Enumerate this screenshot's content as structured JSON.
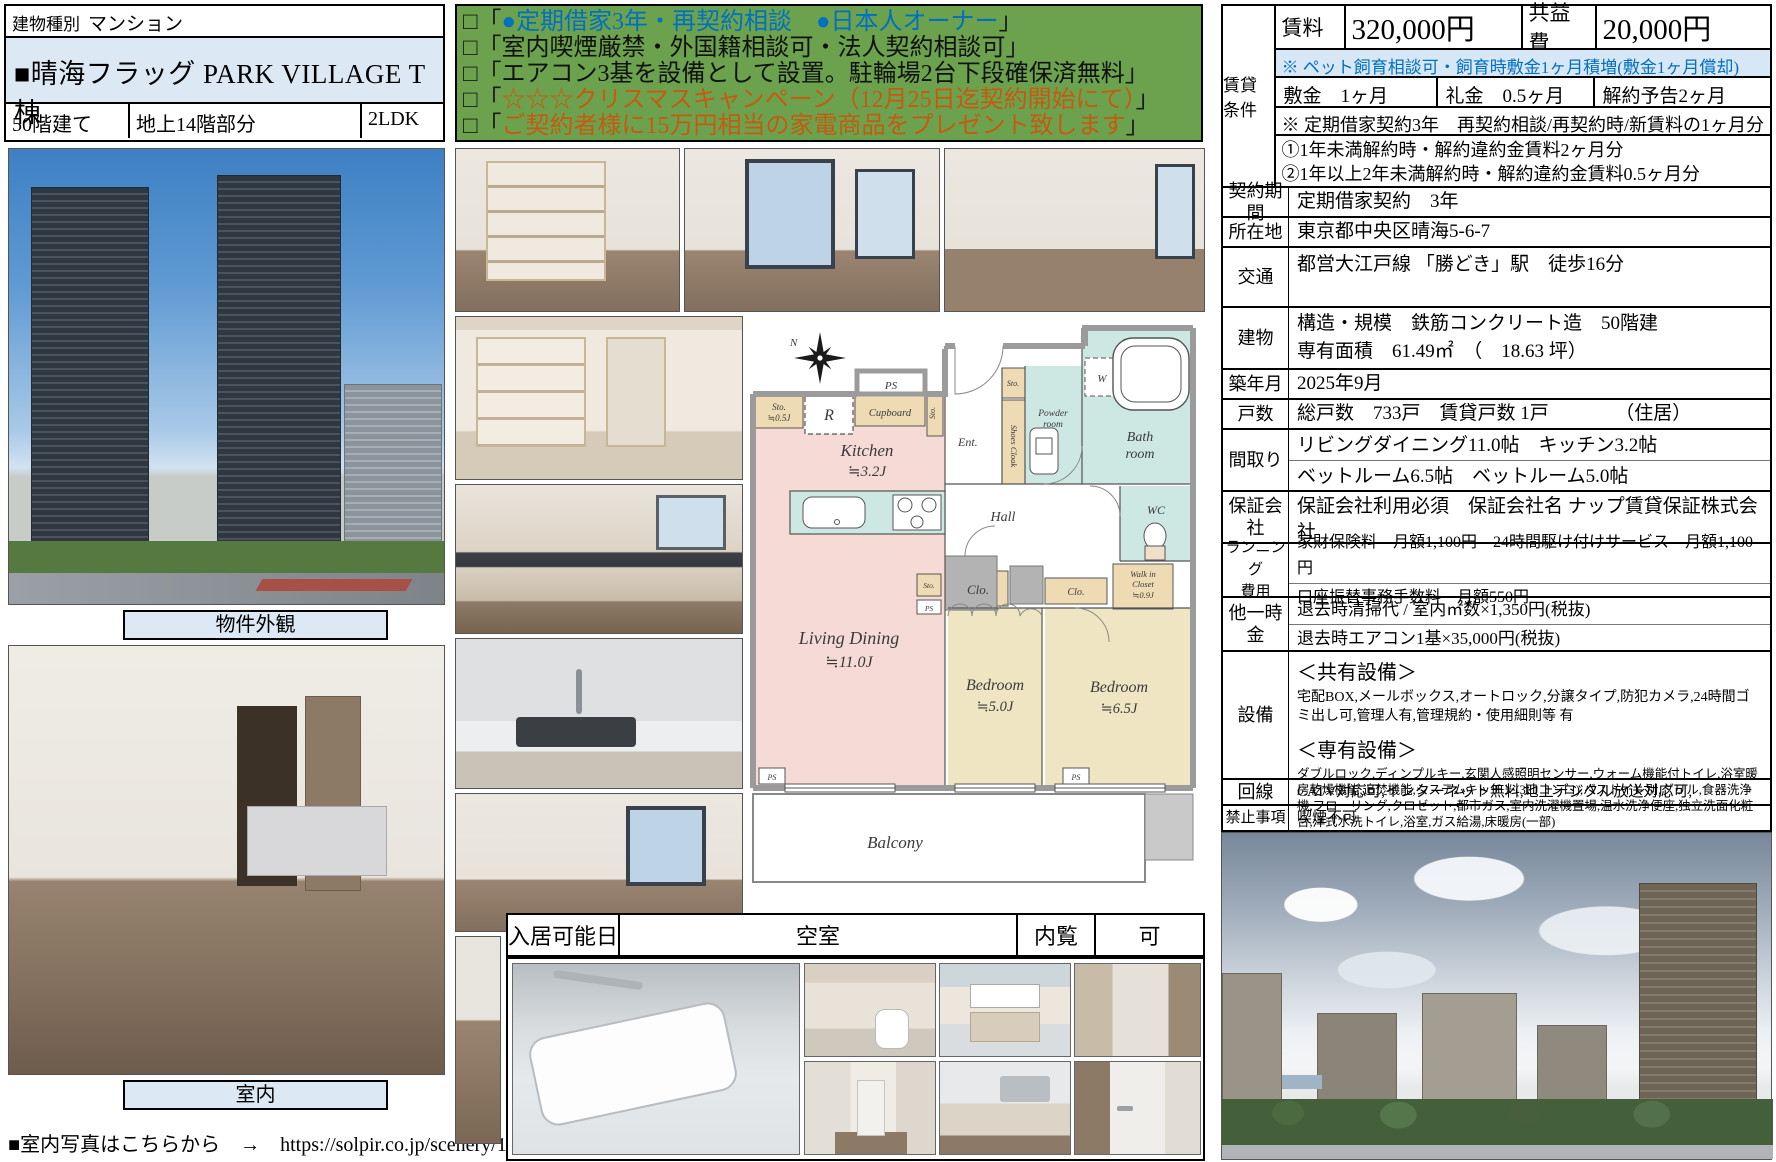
{
  "accent": {
    "light_blue": "#dce9f5",
    "green": "#6ca24d",
    "blue_text": "#0070C0",
    "orange_text": "#C55A11"
  },
  "left_panel": {
    "type_label": "建物種別",
    "type_value": "マンション",
    "title": "■晴海フラッグ PARK VILLAGE T棟",
    "spec_floors": "50階建て",
    "spec_part": "地上14階部分",
    "spec_layout": "2LDK",
    "caption_exterior": "物件外観",
    "caption_interior": "室内",
    "footer_note": "■室内写真はこちらから　→　https://solpir.co.jp/scenery/10184/"
  },
  "promo": {
    "lines": [
      {
        "open": "□「",
        "content": "●定期借家3年・再契約相談　●日本人オーナー",
        "close": "」",
        "style": "color:#0070C0"
      },
      {
        "open": "□「",
        "content": "室内喫煙厳禁・外国籍相談可・法人契約相談可",
        "close": "」",
        "style": "color:#111111"
      },
      {
        "open": "□「",
        "content": "エアコン3基を設備として設置。駐輪場2台下段確保済無料",
        "close": "」",
        "style": "color:#111111"
      },
      {
        "open": "□「",
        "content": "☆☆☆クリスマスキャンペーン（12月25日迄契約開始にて）",
        "close": "」",
        "style": "color:#C55A11"
      },
      {
        "open": "□「",
        "content": "ご契約者様に15万円相当の家電商品をプレゼント致します",
        "close": "」",
        "style": "color:#C55A11"
      }
    ]
  },
  "rental_block": {
    "side_label": "賃貸条件",
    "rent_label": "賃料",
    "rent_value": "320,000円",
    "service_label": "共益費",
    "service_value": "20,000円",
    "pet_note": "※ ペット飼育相談可・飼育時敷金1ヶ月積増(敷金1ヶ月償却)",
    "deposit": "敷金　1ヶ月",
    "key_money": "礼金　0.5ヶ月",
    "cancel_notice": "解約予告2ヶ月",
    "renewal_note": "※ 定期借家契約3年　再契約相談/再契約時/新賃料の1ヶ月分",
    "penalty1": "①1年未満解約時・解約違約金賃料2ヶ月分",
    "penalty2": "②1年以上2年未満解約時・解約違約金賃料0.5ヶ月分"
  },
  "details": {
    "rows": [
      {
        "label": "契約期間",
        "lines": [
          "定期借家契約　3年"
        ]
      },
      {
        "label": "所在地",
        "lines": [
          "東京都中央区晴海5-6-7"
        ]
      },
      {
        "label": "交通",
        "lines": [
          "都営大江戸線 「勝どき」駅　徒歩16分"
        ]
      },
      {
        "label": "建物",
        "lines": [
          "構造・規模　鉄筋コンクリート造　50階建",
          "専有面積　61.49㎡　（　18.63 坪）"
        ]
      },
      {
        "label": "築年月",
        "lines": [
          "2025年9月"
        ]
      },
      {
        "label": "戸数",
        "lines": [
          "総戸数　733戸　賃貸戸数 1戸　　　　（住居）"
        ]
      },
      {
        "label": "間取り",
        "lines": [
          "リビングダイニング11.0帖　キッチン3.2帖",
          "ベットルーム6.5帖　ベットルーム5.0帖"
        ]
      },
      {
        "label": "保証会社",
        "lines": [
          "保証会社利用必須　保証会社名 ナップ賃貸保証株式会社"
        ]
      },
      {
        "label": "ランニング\n費用",
        "lines": [
          "家財保険料　月額1,100円　24時間駆け付けサービス　月額1,100円",
          "口座振替事務手数料　月額550円"
        ]
      },
      {
        "label": "他一時金",
        "lines": [
          "退去時清掃代 / 室内㎡数×1,350円(税抜)",
          "退去時エアコン1基×35,000円(税抜)"
        ]
      },
      {
        "label": "設備",
        "lines": [
          "＜共有設備＞",
          "宅配BOX,メールボックス,オートロック,分譲タイプ,防犯カメラ,24時間ゴミ出し可,管理人有,管理規約・使用細則等 有",
          "＜専有設備＞",
          "ダブルロック,ディンプルキー,玄関人感照明センサー,ウォーム機能付トイレ,浴室暖房乾燥機能,追焚機能,システムキッチン(3口コンロ),バストイレ別,グリル,食器洗浄機,フローリング,クロゼット,都市ガス,室内洗濯機置場,温水洗浄便座,独立洗面化粧台,洋式水洗トイレ,浴室,ガス給湯,床暖房(一部)"
        ]
      },
      {
        "label": "回線",
        "lines": [
          "CATV対応可,インターネット無料,地上デジタル放送対応可,"
        ]
      },
      {
        "label": "禁止事項",
        "lines": [
          "喫煙不可"
        ]
      }
    ]
  },
  "availability": {
    "label": "入居可能日",
    "value": "空室",
    "view_label": "内覧",
    "view_value": "可"
  },
  "floorplan": {
    "north": "N",
    "ps_top": "PS",
    "ps_ld": "PS",
    "ps_bottom_left": "PS",
    "ps_bottom_right": "PS",
    "sto_05a": "Sto.",
    "sto_05b": "≒0.5J",
    "r": "R",
    "cupboard": "Cupboard",
    "sto_vert": "Sto.",
    "kitchen": "Kitchen",
    "kitchen_size": "≒3.2J",
    "ent": "Ent.",
    "sto_entry": "Sto.",
    "shoes_cloak": "Shoes Cloak",
    "powder1": "Powder",
    "powder2": "room",
    "w": "W",
    "bath1": "Bath",
    "bath2": "room",
    "hall": "Hall",
    "wc": "WC",
    "wic1": "Walk in",
    "wic2": "Closet",
    "wic3": "≒0.9J",
    "sto_mid": "Sto.",
    "clo1": "Clo.",
    "clo2": "Clo.",
    "living1": "Living Dining",
    "living2": "≒11.0J",
    "bed1a": "Bedroom",
    "bed1b": "≒5.0J",
    "bed2a": "Bedroom",
    "bed2b": "≒6.5J",
    "balcony": "Balcony"
  }
}
